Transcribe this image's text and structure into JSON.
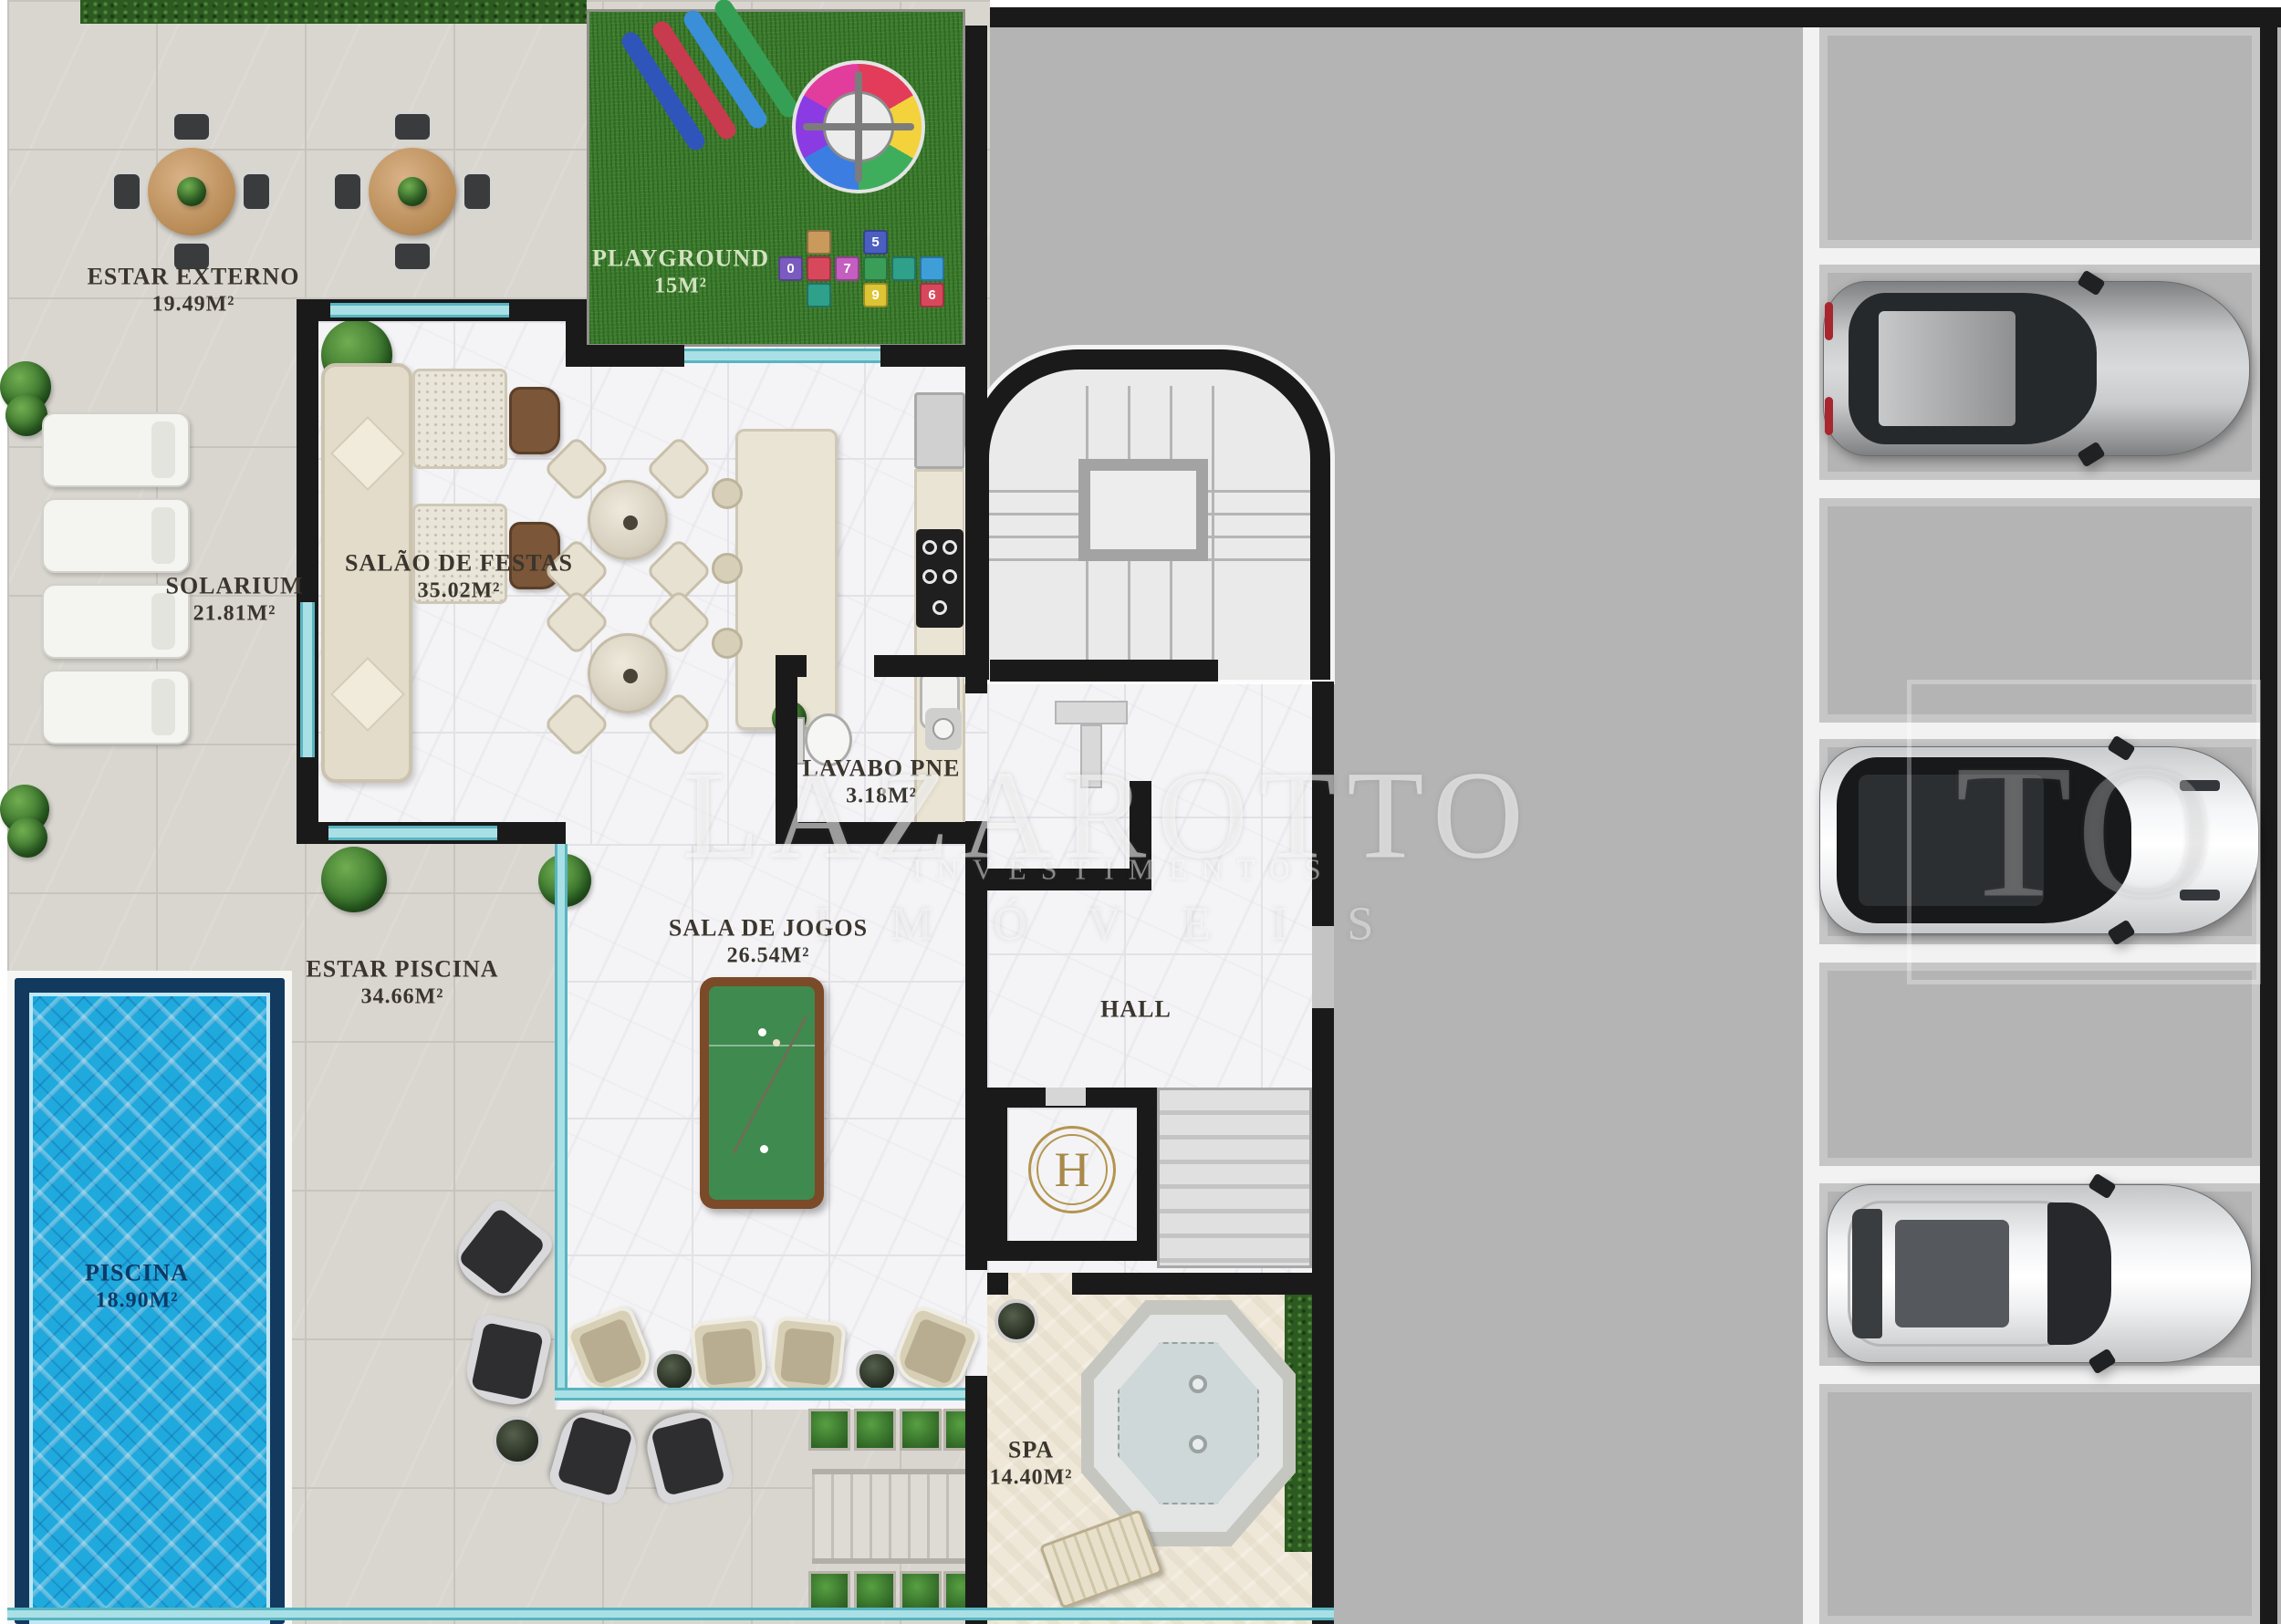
{
  "watermark": {
    "brand": "LAZAROTTO",
    "line2": "INVESTIMENTOS",
    "line3": "IMÓVEIS",
    "ghost": "TO"
  },
  "rooms": {
    "estar_externo": {
      "name": "ESTAR EXTERNO",
      "area": "19.49M²"
    },
    "playground": {
      "name": "PLAYGROUND",
      "area": "15M²"
    },
    "solarium": {
      "name": "SOLARIUM",
      "area": "21.81M²"
    },
    "salao_de_festas": {
      "name": "SALÃO DE FESTAS",
      "area": "35.02M²"
    },
    "lavabo_pne": {
      "name": "LAVABO PNE",
      "area": "3.18M²"
    },
    "sala_de_jogos": {
      "name": "SALA DE JOGOS",
      "area": "26.54M²"
    },
    "estar_piscina": {
      "name": "ESTAR PISCINA",
      "area": "34.66M²"
    },
    "hall": {
      "name": "HALL"
    },
    "piscina": {
      "name": "PISCINA",
      "area": "18.90M²"
    },
    "spa": {
      "name": "SPA",
      "area": "14.40M²"
    }
  },
  "elevator": {
    "monogram": "H"
  },
  "playground_tiles": {
    "digits": [
      "0",
      "7",
      "5",
      "9",
      "6"
    ]
  },
  "garage": {
    "parking_spots": 7,
    "cars": [
      {
        "type": "sedan",
        "body_color": "silver-gray",
        "roof": "dark glass"
      },
      {
        "type": "suv",
        "body_color": "white",
        "roof": "black panoramic"
      },
      {
        "type": "suv",
        "body_color": "white",
        "roof": "gray sunroof"
      }
    ]
  },
  "colors": {
    "tile": "#d9d6d0",
    "marble": "#f4f4f6",
    "grass": "#3b7c2c",
    "travertine": "#efe8d9",
    "garage": "#b4b4b4",
    "wall": "#1a1a1a",
    "glass": "#a9e0e6",
    "pool_water": "#1fa9dd",
    "pool_border": "#123a5e",
    "gold": "#b3954f",
    "felt_green": "#3f8a4f"
  }
}
